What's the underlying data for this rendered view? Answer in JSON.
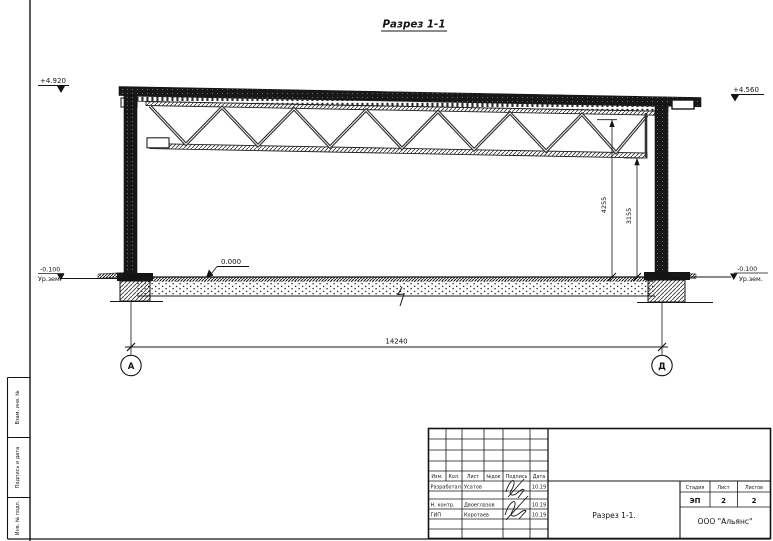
{
  "sheet": {
    "title": "Разрез 1-1"
  },
  "section": {
    "elev_left": "+4.920",
    "elev_right": "+4.560",
    "elev_floor": "0.000",
    "elev_ground_left": "-0.100",
    "ground_label_left": "Ур.зем.",
    "elev_ground_right": "-0.100",
    "ground_label_right": "Ур.зем.",
    "dim_height_total": "4255",
    "dim_height_truss": "3155",
    "dim_span": "14240",
    "axis_left": "А",
    "axis_right": "Д"
  },
  "side_strip": {
    "box1": "Взам. инв. №",
    "box2": "Подпись и дата",
    "box3": "Инв. № подл."
  },
  "title_block": {
    "col_izm": "Изм.",
    "col_kol": "Кол.",
    "col_list": "Лист",
    "col_ndok": "№док",
    "col_sign": "Подпись",
    "col_date": "Дата",
    "row1_role": "Разработал",
    "row1_name": "Усатов",
    "row1_date": "10.19",
    "row2_role": "Н. контр.",
    "row2_name": "Двоеглазов",
    "row2_date": "10.19",
    "row3_role": "ГИП",
    "row3_name": "Коротаев",
    "row3_date": "10.19",
    "stage_label": "Стадия",
    "sheet_label": "Лист",
    "sheets_label": "Листов",
    "stage": "ЭП",
    "sheet_num": "2",
    "sheets_total": "2",
    "doc_title": "Разрез 1-1.",
    "company": "ООО \"Альянс\""
  },
  "colors": {
    "ink": "#141414",
    "paper": "#ffffff"
  }
}
